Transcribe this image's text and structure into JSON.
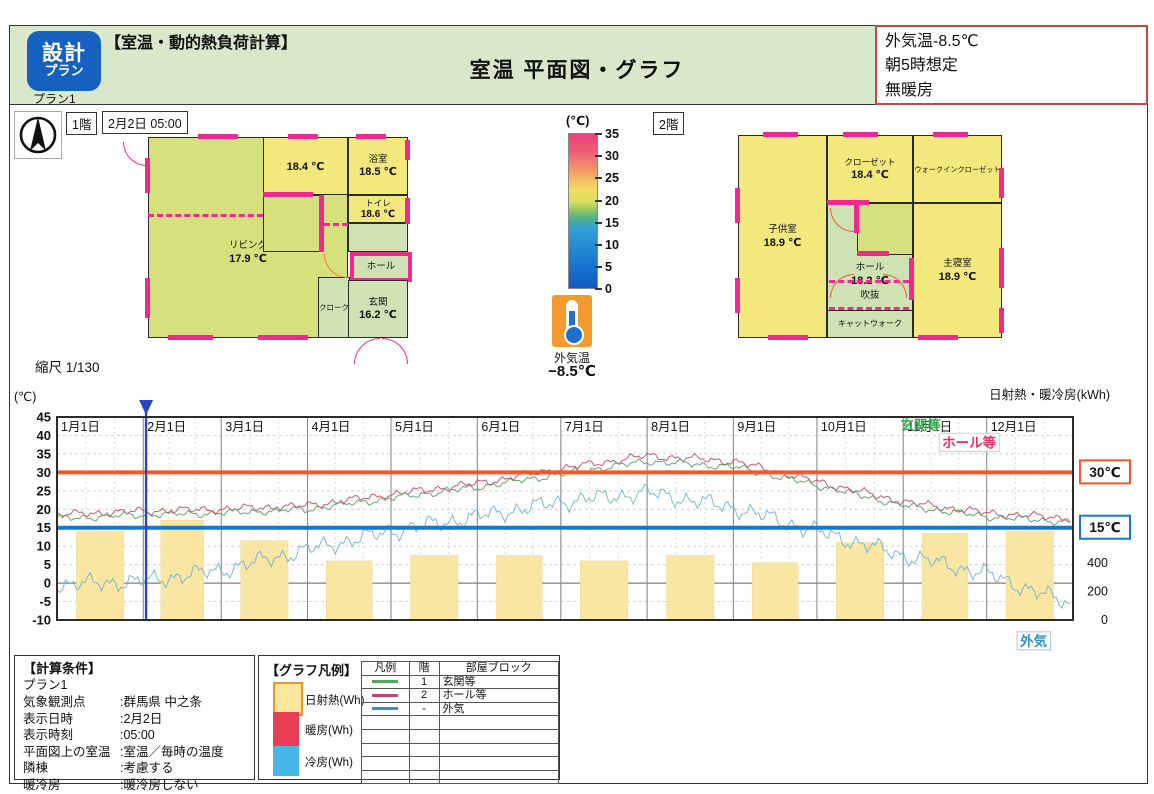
{
  "colors": {
    "header_green": "#d9e8cb",
    "logo_blue": "#1660c0",
    "accent_pink": "#ee2a90",
    "note_border_red": "#c8463f",
    "room_yellow": "#f3e87b",
    "room_green": "#cfe2b4",
    "living_yellowgreen": "#d6e07c",
    "threshold_orange": "#f1582b",
    "threshold_blue": "#1878c8"
  },
  "icons": {
    "compass_north_arrow": "▲",
    "thermometer": "temperature-indicator"
  },
  "header": {
    "logo_top": "設計",
    "logo_bottom": "プラン",
    "plan_name": "プラン1",
    "section_title": "【室温・動的熱負荷計算】",
    "page_title": "室温 平面図・グラフ",
    "note_lines": [
      "外気温-8.5℃",
      "朝5時想定",
      "無暖房"
    ]
  },
  "floor1": {
    "label": "1階",
    "datetime": "2月2日 05:00",
    "rooms": {
      "living": {
        "name": "リビング",
        "temp": "17.9 ℃"
      },
      "washroom": {
        "name": "",
        "temp": "18.4 ℃"
      },
      "bathroom": {
        "name": "浴室",
        "temp": "18.5 ℃"
      },
      "toilet": {
        "name": "トイレ",
        "temp": "18.6 ℃"
      },
      "hall": {
        "name": "ホール",
        "temp": ""
      },
      "cloak": {
        "name": "クローク",
        "temp": ""
      },
      "entrance": {
        "name": "玄関",
        "temp": "16.2 ℃"
      }
    }
  },
  "floor2": {
    "label": "2階",
    "rooms": {
      "kids": {
        "name": "子供室",
        "temp": "18.9 ℃"
      },
      "closet": {
        "name": "クローゼット",
        "temp": "18.4 ℃"
      },
      "wic": {
        "name": "ウォークインクローゼット",
        "temp": ""
      },
      "hall": {
        "name": "ホール",
        "temp": "18.2 ℃"
      },
      "void": {
        "name": "吹抜",
        "temp": ""
      },
      "catwalk": {
        "name": "キャットウォーク",
        "temp": ""
      },
      "master": {
        "name": "主寝室",
        "temp": "18.9 ℃"
      }
    }
  },
  "scale_note": "縮尺 1/130",
  "color_scale": {
    "unit": "(℃)",
    "ticks": [
      35,
      30,
      25,
      20,
      15,
      10,
      5,
      0
    ]
  },
  "outdoor_thermo": {
    "label": "外気温",
    "value": "−8.5℃"
  },
  "chart_data": {
    "type": "line+bar",
    "unit_left": "(℃)",
    "title_right": "日射熱・暖冷房(kWh)",
    "x_labels": [
      "1月1日",
      "2月1日",
      "3月1日",
      "4月1日",
      "5月1日",
      "6月1日",
      "7月1日",
      "8月1日",
      "9月1日",
      "10月1日",
      "11月1日",
      "12月1日"
    ],
    "month_days": [
      31,
      28,
      31,
      30,
      31,
      30,
      31,
      31,
      30,
      31,
      30,
      31
    ],
    "y_left": {
      "min": -10,
      "max": 45,
      "step": 5
    },
    "y_right": {
      "ticks": [
        400,
        200,
        0
      ],
      "kwh_per_c": 26,
      "offset_c": -10
    },
    "threshold_lines": [
      {
        "value": 30,
        "label": "30℃",
        "color": "#f1582b"
      },
      {
        "value": 15,
        "label": "15℃",
        "color": "#1878c8"
      }
    ],
    "marker": {
      "day": 32,
      "date": "2月2日",
      "color": "#2b44c0"
    },
    "bars": {
      "name": "日射熱",
      "color": "#f9e6a2",
      "values_kwh": [
        624,
        702,
        559,
        416,
        455,
        455,
        416,
        455,
        403,
        546,
        611,
        624
      ]
    },
    "series": [
      {
        "name": "玄関等",
        "floor": "1",
        "color": "#569e5e",
        "wiggle": 1.1,
        "monthly_c": [
          17.5,
          18.5,
          19,
          20,
          23,
          26,
          29.5,
          33,
          31.5,
          26.5,
          21,
          18,
          16.5
        ]
      },
      {
        "name": "ホール等",
        "floor": "2",
        "color": "#c04a6a",
        "wiggle": 1.2,
        "monthly_c": [
          18.5,
          19.5,
          20,
          21,
          24,
          27,
          31,
          34.5,
          33,
          27.5,
          22,
          19,
          17.5
        ]
      },
      {
        "name": "外気",
        "floor": "-",
        "color": "#6fb0d6",
        "wiggle": 2.6,
        "monthly_c": [
          -0.5,
          0.5,
          3.5,
          9,
          14,
          18,
          22,
          24.5,
          20.5,
          14,
          7.5,
          2.5,
          -6
        ]
      }
    ],
    "annotations": [
      {
        "text": "玄関等",
        "color": "#2eb44a",
        "x_day": 303,
        "y_c": 41.5,
        "boxed": false
      },
      {
        "text": "ホール等",
        "color": "#e62e66",
        "x_day": 318,
        "y_c": 36.8,
        "boxed": true,
        "box_border": "#cccccc"
      },
      {
        "text": "外気",
        "color": "#2f93c9",
        "x_day": 346,
        "y_c": -17,
        "boxed": true,
        "box_border": "#9fc8e8"
      }
    ]
  },
  "conditions": {
    "title": "【計算条件】",
    "rows": [
      {
        "label": "プラン1",
        "value": ""
      },
      {
        "label": "気象観測点",
        "value": ":群馬県 中之条"
      },
      {
        "label": "表示日時",
        "value": ":2月2日"
      },
      {
        "label": "表示時刻",
        "value": ":05:00"
      },
      {
        "label": "平面図上の室温",
        "value": ":室温／毎時の温度"
      },
      {
        "label": "隣棟",
        "value": ":考慮する"
      },
      {
        "label": "暖冷房",
        "value": ":暖冷房しない"
      }
    ]
  },
  "graph_legend": {
    "title": "【グラフ凡例】",
    "swatches": [
      {
        "label": "日射熱(Wh)",
        "color": "#fbe7a0",
        "border": "#ef9426"
      },
      {
        "label": "暖房(Wh)",
        "color": "#e73e53",
        "border": "#e73e53"
      },
      {
        "label": "冷房(Wh)",
        "color": "#47b6e8",
        "border": "#47b6e8"
      }
    ],
    "table": {
      "headers": [
        "凡例",
        "階",
        "部屋ブロック"
      ],
      "rows": [
        {
          "line_color": "#4cae5c",
          "floor": "1",
          "block": "玄関等"
        },
        {
          "line_color": "#c2456b",
          "floor": "2",
          "block": "ホール等"
        },
        {
          "line_color": "#2f93c9",
          "floor": "-",
          "block": "外気"
        }
      ]
    }
  }
}
